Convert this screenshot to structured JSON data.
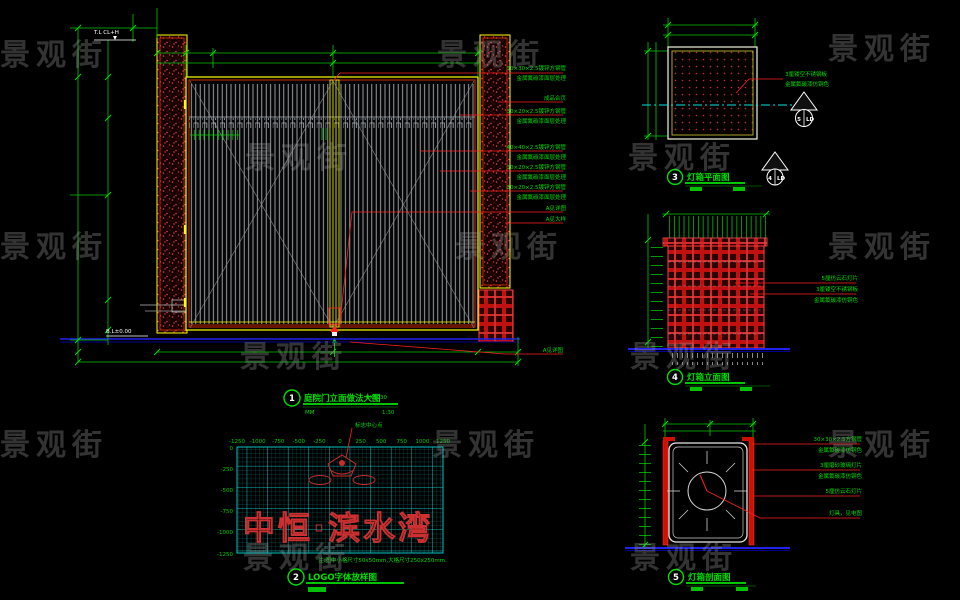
{
  "watermark": {
    "text": "景观街"
  },
  "d1": {
    "no": "1",
    "title": "庭院门立面做法大图",
    "code": "EXT030",
    "units": "MM",
    "scale": "1:30",
    "elev_top": "T.L CL+H",
    "elev_bottom": "B.L±0.00",
    "ann": [
      {
        "l1": "30×30×2.5镀锌方钢管",
        "l2": "金属氟碳漆面层处理"
      },
      {
        "l1": "成品合页"
      },
      {
        "l1": "30×20×2.5镀锌方钢管",
        "l2": "金属氟碳漆面层处理"
      },
      {
        "l1": "40×40×2.5镀锌方钢管",
        "l2": "金属氟碳漆面层处理"
      },
      {
        "l1": "30×20×2.5镀锌方钢管",
        "l2": "金属氟碳漆面层处理"
      },
      {
        "l1": "30×20×2.5镀锌方钢管",
        "l2": "金属氟碳漆面层处理"
      },
      {
        "l1": "A见详图"
      },
      {
        "l1": "A见大样"
      },
      {
        "l1": "A见详图"
      }
    ]
  },
  "d2": {
    "no": "2",
    "title": "LOGO字体放样图",
    "center_label": "标志中心点",
    "logo_text": "中恒·滨水湾",
    "note": "注:图中小格尺寸50x50mm,大格尺寸250x250mm.",
    "x_labels": [
      "-1250",
      "-1000",
      "-750",
      "-500",
      "-250",
      "0",
      "250",
      "500",
      "750",
      "1000",
      "1250"
    ],
    "y_labels": [
      "0",
      "-250",
      "-500",
      "-750",
      "-1000",
      "-1250"
    ]
  },
  "d3": {
    "no": "3",
    "title": "灯箱平面图",
    "ann1": "3厘镂空不锈钢板",
    "ann2": "金属氟碳漆仿铜色",
    "markers": [
      {
        "num": "5",
        "sheet": "LD"
      },
      {
        "num": "4",
        "sheet": "LD"
      }
    ]
  },
  "d4": {
    "no": "4",
    "title": "灯箱立面图",
    "ann": [
      "5厘仿云石灯片",
      "3厘镂空不锈钢板",
      "金属氟碳漆仿铜色"
    ]
  },
  "d5": {
    "no": "5",
    "title": "灯箱剖面图",
    "ann": [
      {
        "l1": "30×30×2.5方钢管",
        "l2": "金属氟碳漆仿铜色"
      },
      {
        "l1": "3厘磨砂玻璃灯片",
        "l2": "金属氟碳漆仿铜色"
      },
      {
        "l1": "5厘仿云石灯片"
      },
      {
        "l1": "灯具，见电图"
      }
    ]
  },
  "colors": {
    "dim_green": "#00c800",
    "annotation_green": "#00dd00",
    "leader_red": "#ff2020",
    "frame_yellow": "#ffff00",
    "frame_red": "#ff3300",
    "grid_cyan": "#00d8d8",
    "ground_blue": "#2222ee"
  }
}
